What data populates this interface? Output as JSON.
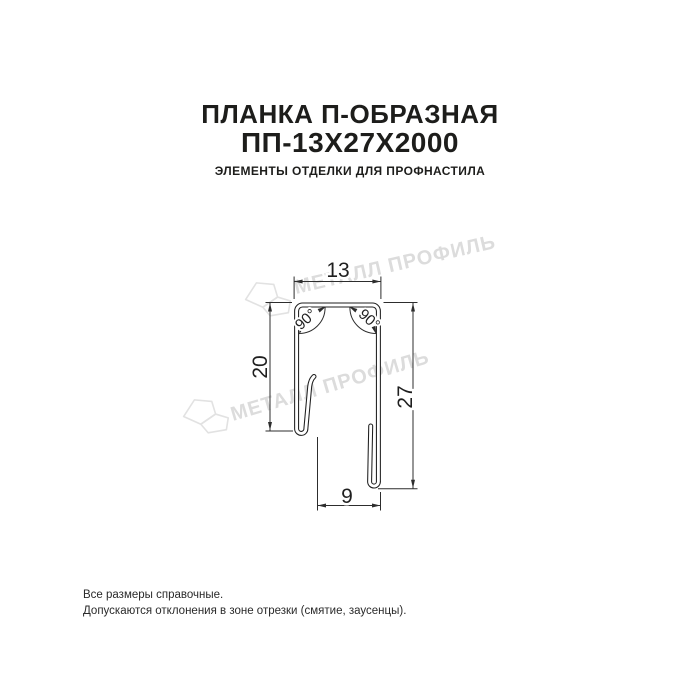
{
  "header": {
    "title_line1": "ПЛАНКА П-ОБРАЗНАЯ",
    "title_line2": "ПП-13Х27Х2000",
    "subtitle": "ЭЛЕМЕНТЫ ОТДЕЛКИ ДЛЯ ПРОФНАСТИЛА"
  },
  "drawing": {
    "dimensions": {
      "top_width": "13",
      "left_height": "20",
      "right_height": "27",
      "bottom_width": "9",
      "left_angle": "90°",
      "right_angle": "90°"
    },
    "line_color": "#2d2d2d"
  },
  "watermarks": [
    {
      "text": "МЕТАЛЛ ПРОФИЛЬ"
    },
    {
      "text": "МЕТАЛЛ ПРОФИЛЬ"
    }
  ],
  "watermark_color": "#dcdcdc",
  "footnotes": {
    "line1": "Все размеры справочные.",
    "line2": "Допускаются отклонения в зоне отрезки (смятие, заусенцы)."
  }
}
